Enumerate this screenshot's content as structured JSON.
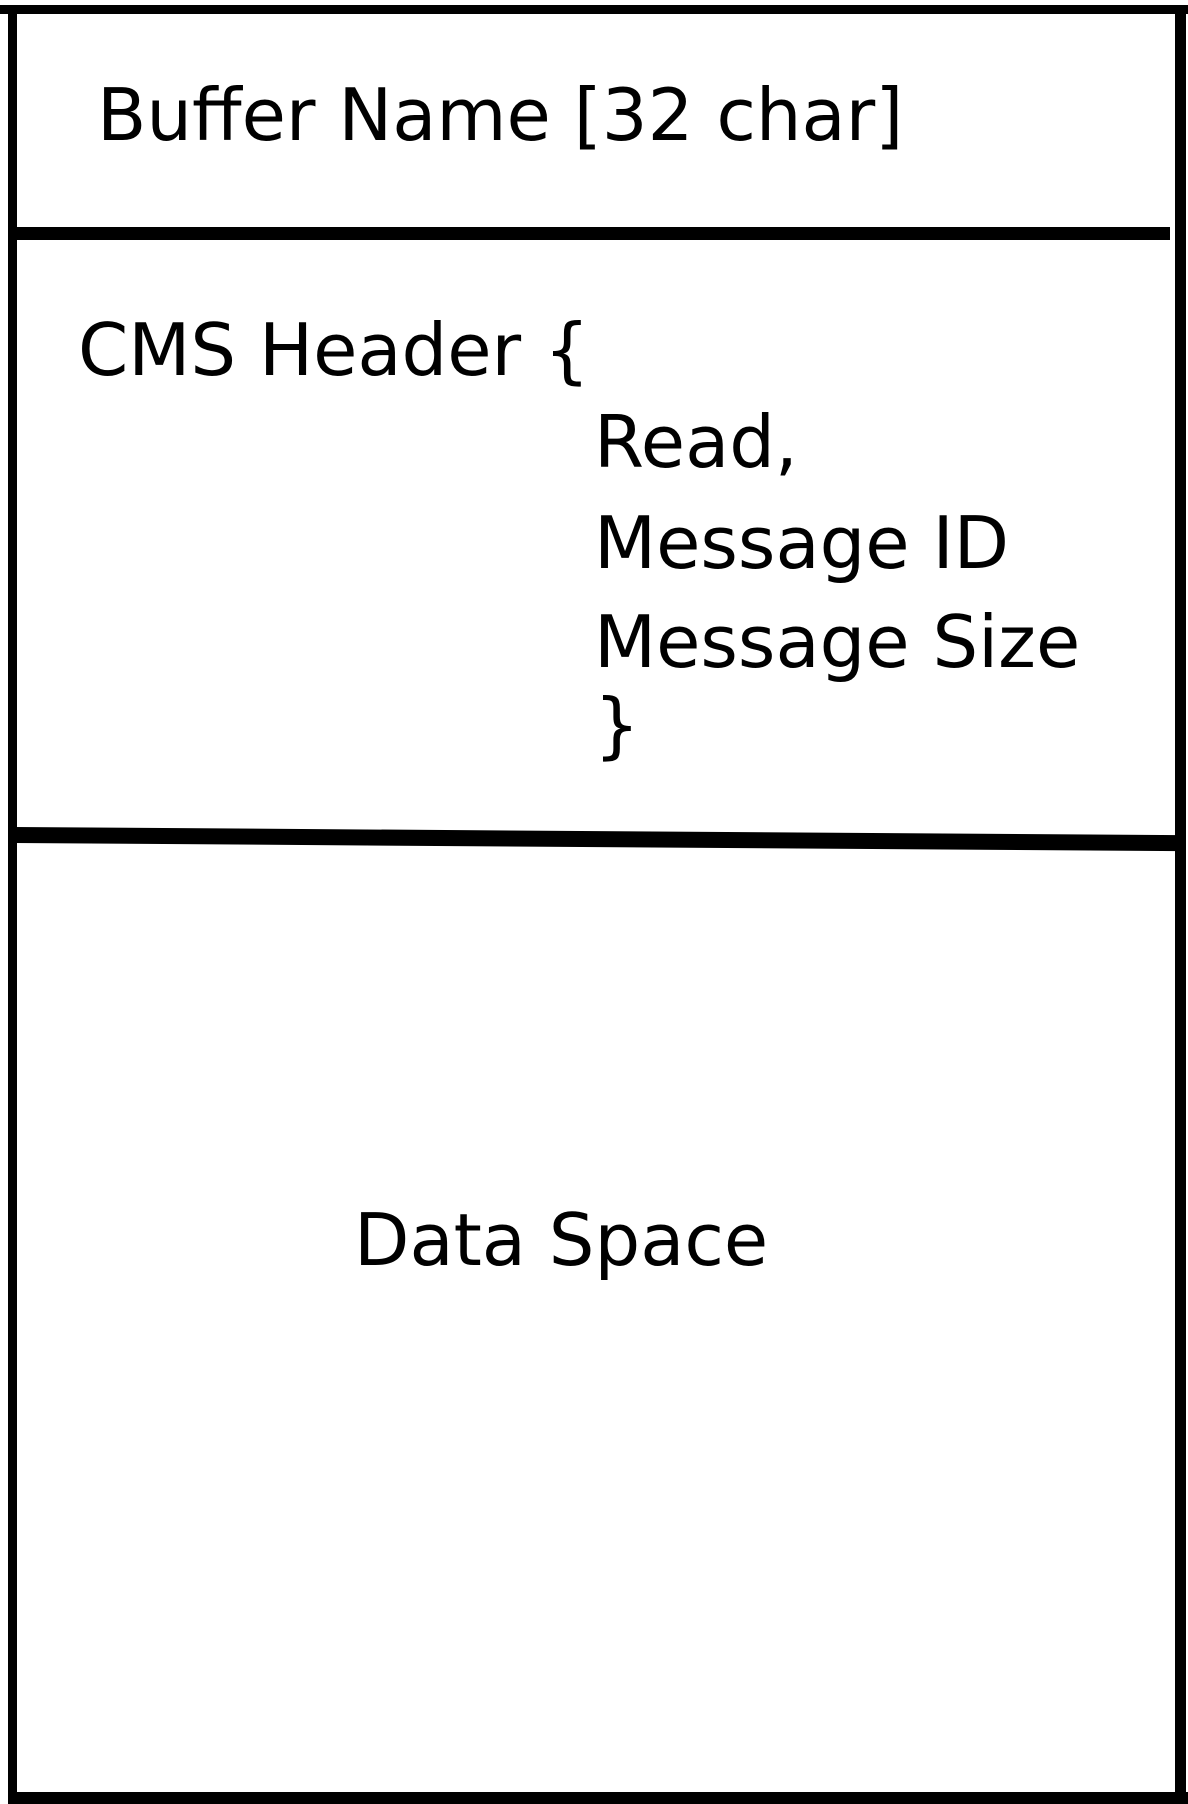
{
  "diagram": {
    "type": "memory-buffer-layout",
    "background": "#ffffff",
    "border_color": "#000000",
    "text_color": "#000000",
    "sections": [
      {
        "id": "buffer-name",
        "label": "Buffer Name [32 char]"
      },
      {
        "id": "cms-header",
        "label": "CMS Header {",
        "fields": [
          "Read,",
          "Message ID",
          "Message Size"
        ],
        "close_brace": "}"
      },
      {
        "id": "data-space",
        "label": "Data Space"
      }
    ]
  }
}
